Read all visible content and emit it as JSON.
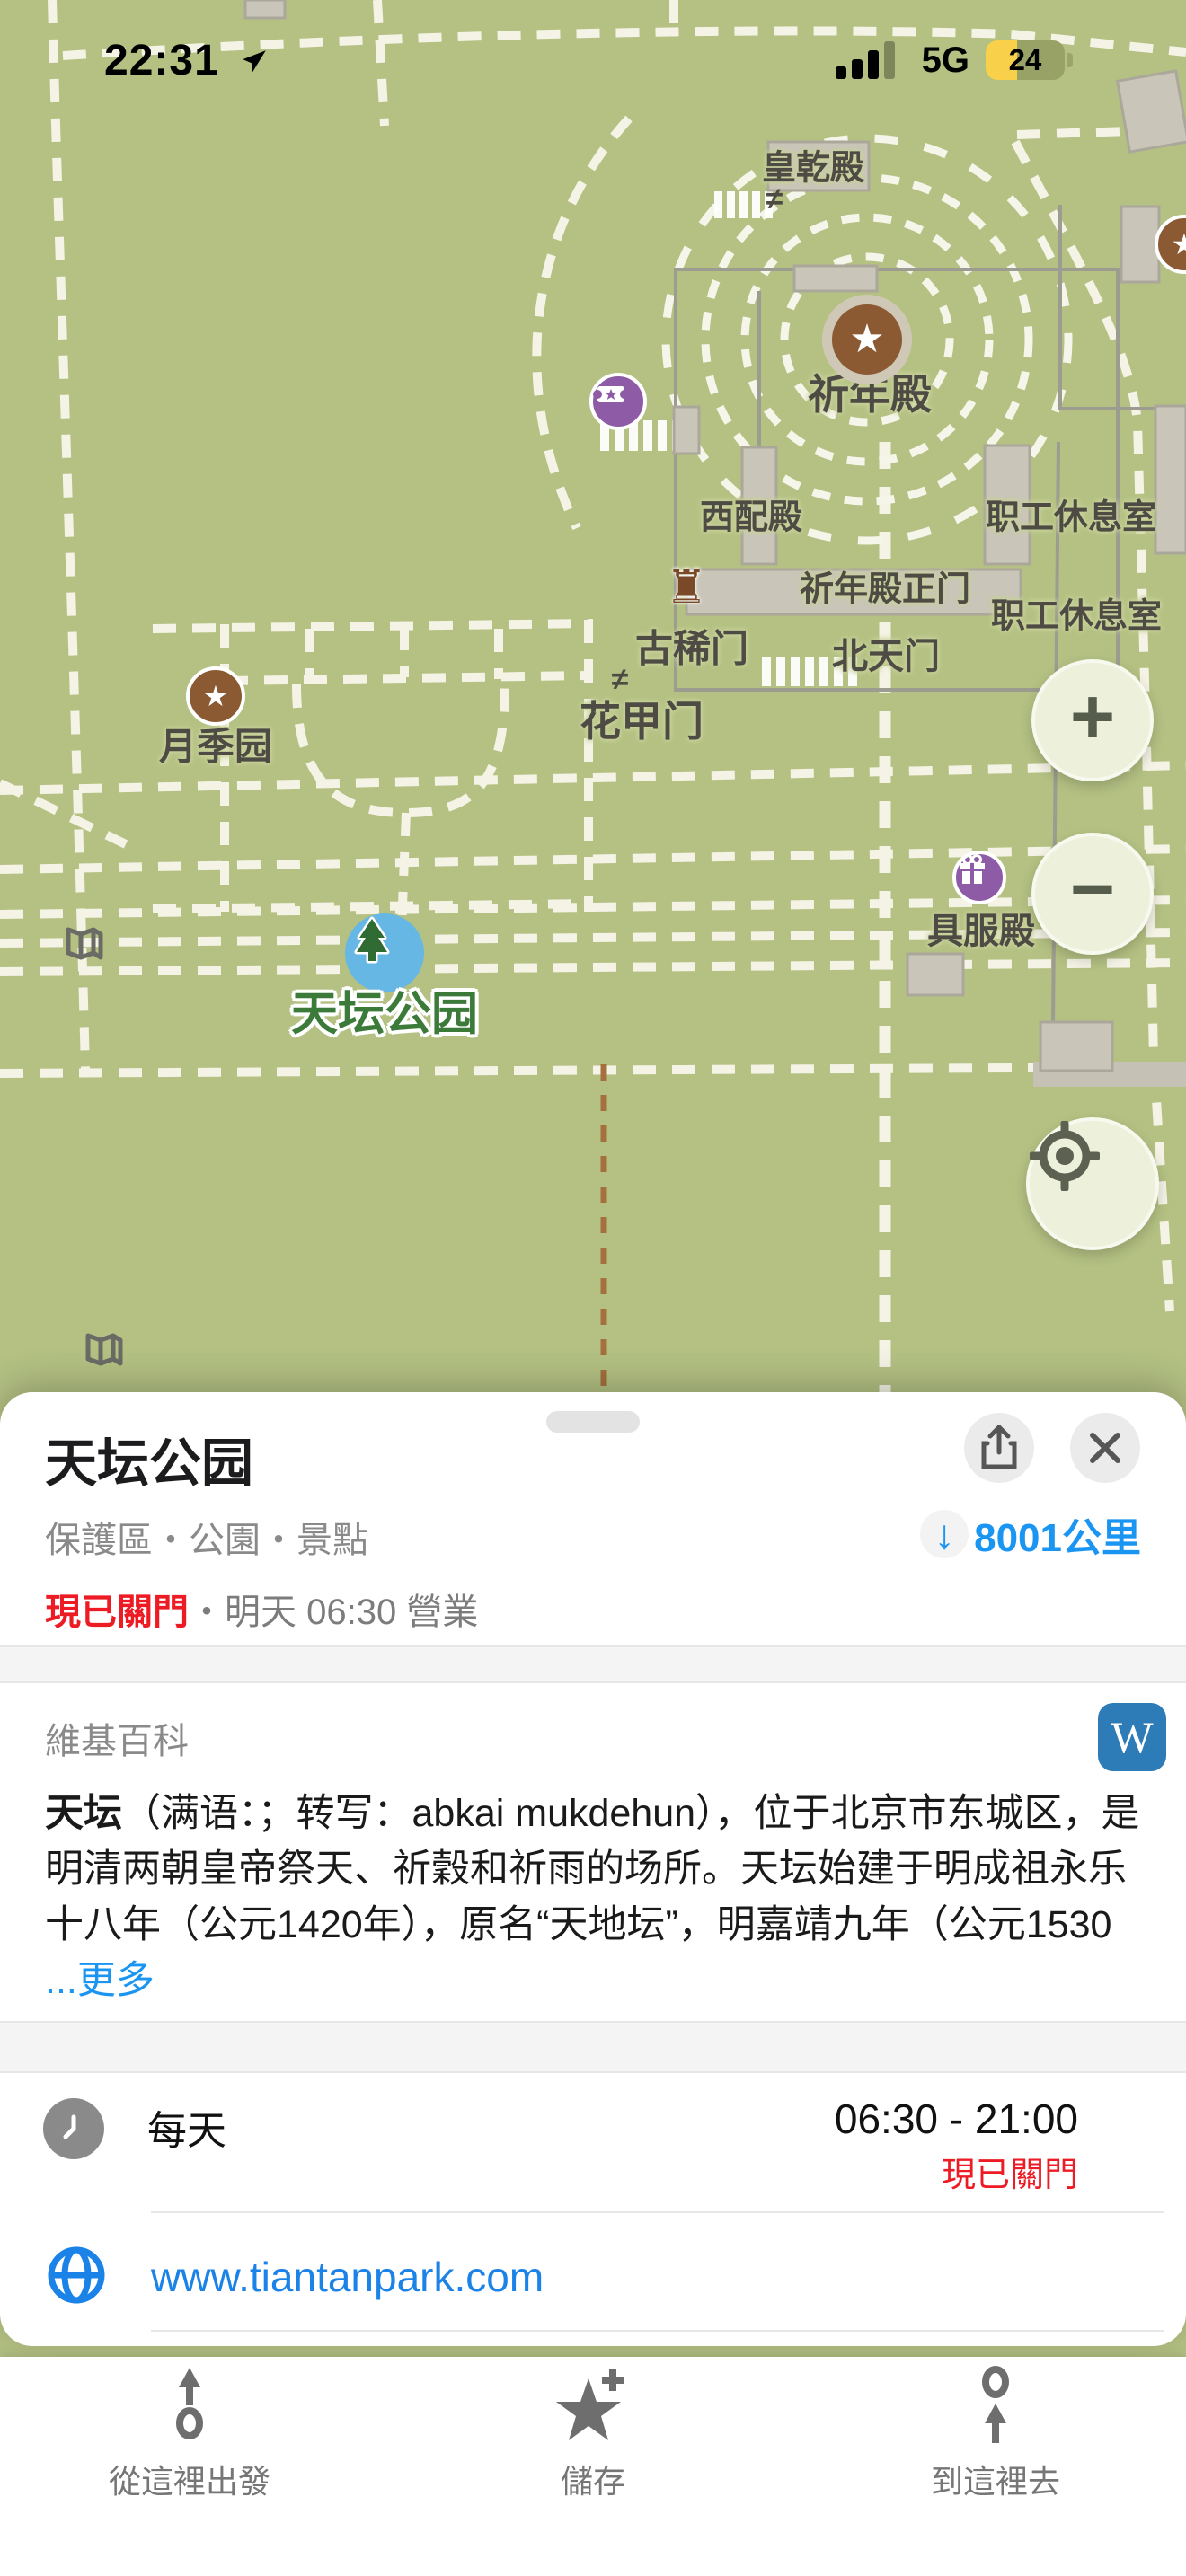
{
  "status_bar": {
    "time": "22:31",
    "network": "5G",
    "battery_percent": "24"
  },
  "map": {
    "labels": [
      {
        "text": "皇乾殿"
      },
      {
        "text": "祈年殿"
      },
      {
        "text": "西配殿"
      },
      {
        "text": "职工休息室"
      },
      {
        "text": "祈年殿正门"
      },
      {
        "text": "职工休息室"
      },
      {
        "text": "古稀门"
      },
      {
        "text": "北天门"
      },
      {
        "text": "花甲门"
      },
      {
        "text": "月季园"
      },
      {
        "text": "具服殿"
      }
    ],
    "park_label": "天坛公园",
    "gate_symbol": "≠",
    "castle_symbol": "♜",
    "star_glyph": "★",
    "colors": {
      "land": "#b4c183",
      "dashed_path": "#f4f3e5",
      "building": "#c9c5b9",
      "poi_brown": "#8b5a33",
      "poi_purple": "#8e5ba6",
      "poi_blue": "#66b7e4",
      "park_label_green": "#3c7a39"
    }
  },
  "controls": {
    "zoom_in": "+",
    "zoom_out": "−"
  },
  "sheet": {
    "title": "天坛公园",
    "categories": "保護區・公園・景點",
    "arrow_down": "↓",
    "distance": "8001公里",
    "status": {
      "closed": "現已關門",
      "sep": "・",
      "info": "明天 06:30 營業"
    },
    "wiki": {
      "header": "維基百科",
      "w": "W",
      "term": "天坛",
      "body": "（满语：；转写：abkai mukdehun），位于北京市东城区，是明清两朝皇帝祭天、祈穀和祈雨的场所。天坛始建于明成祖永乐十八年（公元1420年），原名“天地坛”，明嘉靖九年（公元1530",
      "more": "...更多"
    },
    "hours": {
      "days": "每天",
      "time": "06:30 - 21:00",
      "status": "現已關門"
    },
    "website": "www.tiantanpark.com"
  },
  "toolbar": {
    "route_from": "從這裡出發",
    "save": "儲存",
    "route_to": "到這裡去"
  }
}
